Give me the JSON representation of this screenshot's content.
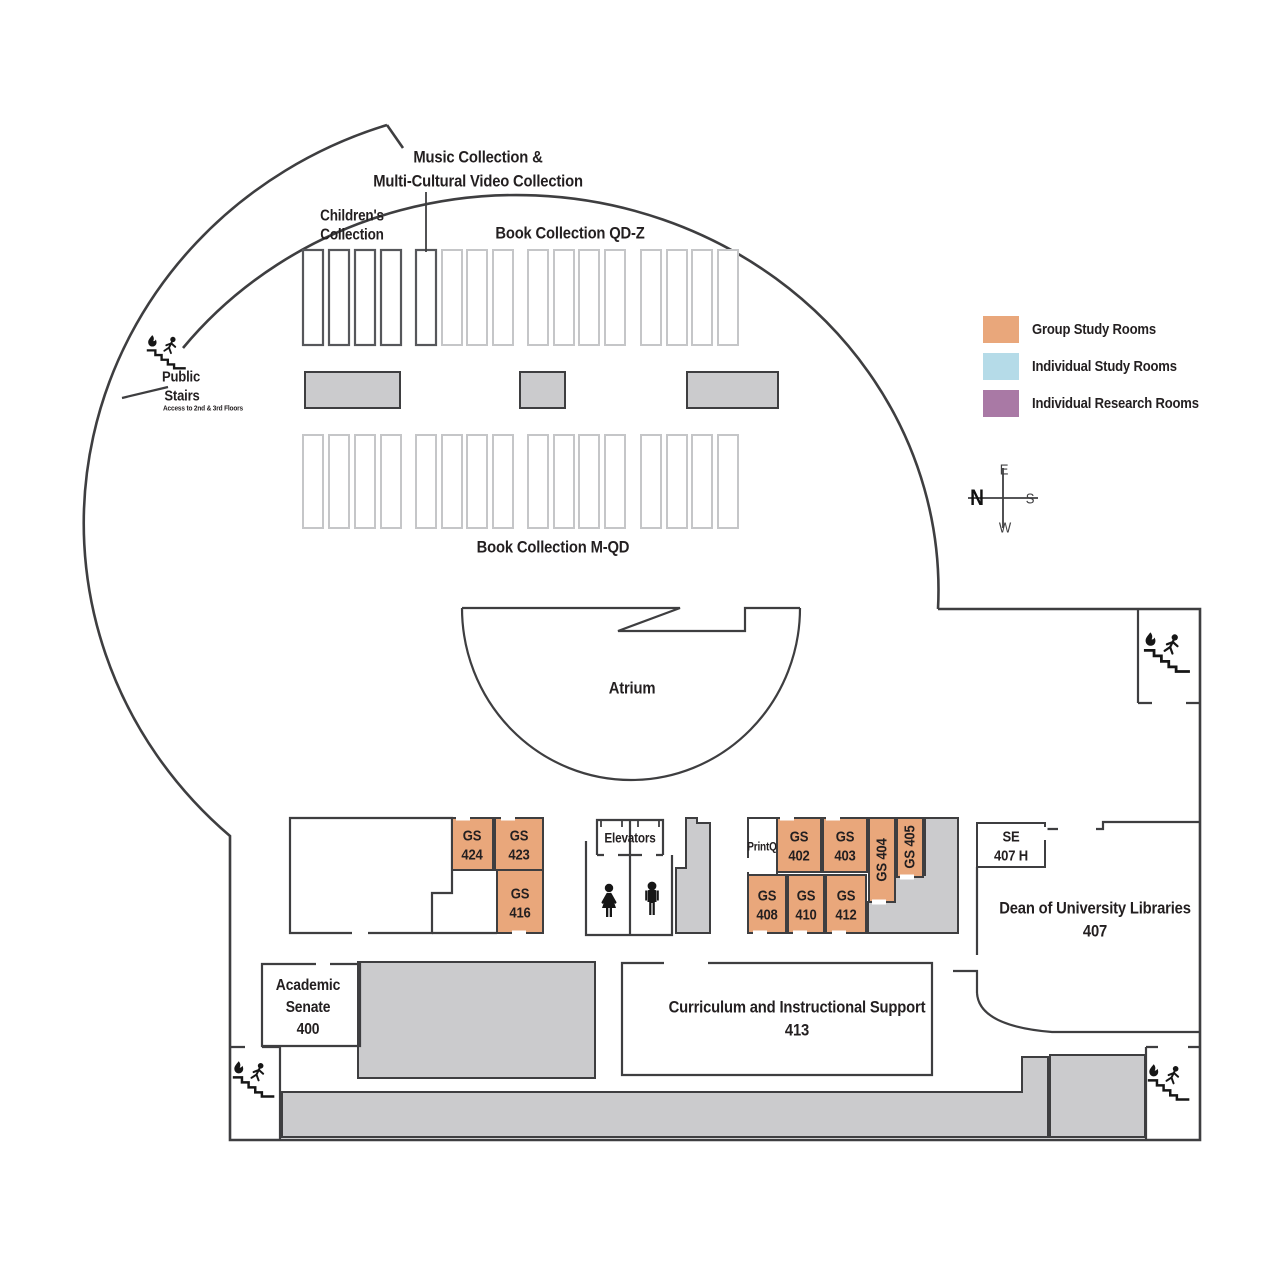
{
  "legend": {
    "items": [
      {
        "label": "Group Study Rooms",
        "color": "#E9A77B"
      },
      {
        "label": "Individual Study Rooms",
        "color": "#B5DBE8"
      },
      {
        "label": "Individual Research Rooms",
        "color": "#A979A5"
      }
    ]
  },
  "colors": {
    "group_study": "#E9A77B",
    "individual_study": "#B5DBE8",
    "individual_research": "#A979A5",
    "gray_area": "#CBCBCD",
    "wall": "#3E3E40"
  },
  "compass": {
    "north": "N",
    "east": "E",
    "south": "S",
    "west": "W"
  },
  "collections": {
    "music_line1": "Music Collection &",
    "music_line2": "Multi-Cultural Video Collection",
    "childrens_line1": "Children's",
    "childrens_line2": "Collection",
    "book_qdz": "Book Collection QD-Z",
    "book_mqd": "Book Collection M-QD"
  },
  "atrium_label": "Atrium",
  "public_stairs": {
    "line1": "Public",
    "line2": "Stairs",
    "note": "Access to 2nd & 3rd Floors"
  },
  "facilities": {
    "elevators": "Elevators",
    "printq": "PrintQ"
  },
  "rooms": {
    "gs424": {
      "l1": "GS",
      "l2": "424"
    },
    "gs423": {
      "l1": "GS",
      "l2": "423"
    },
    "gs416": {
      "l1": "GS",
      "l2": "416"
    },
    "gs402": {
      "l1": "GS",
      "l2": "402"
    },
    "gs403": {
      "l1": "GS",
      "l2": "403"
    },
    "gs404": {
      "label": "GS 404"
    },
    "gs405": {
      "label": "GS 405"
    },
    "gs408": {
      "l1": "GS",
      "l2": "408"
    },
    "gs410": {
      "l1": "GS",
      "l2": "410"
    },
    "gs412": {
      "l1": "GS",
      "l2": "412"
    },
    "se407h": {
      "l1": "SE",
      "l2": "407 H"
    },
    "dean": {
      "l1": "Dean of University Libraries",
      "l2": "407"
    },
    "academic_senate": {
      "l1": "Academic",
      "l2": "Senate",
      "l3": "400"
    },
    "curriculum": {
      "l1": "Curriculum and Instructional Support",
      "l2": "413"
    }
  }
}
